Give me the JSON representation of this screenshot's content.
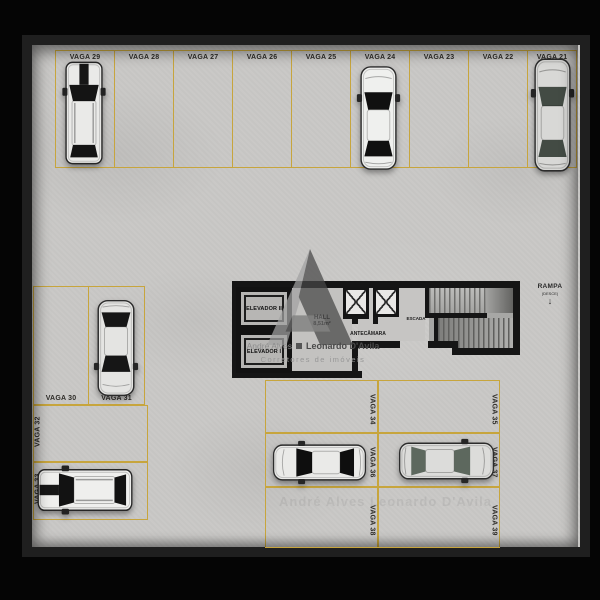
{
  "scene": {
    "description": "parking garage floor plan, top-down view"
  },
  "colors": {
    "background": "#050505",
    "wall": "#1f1f1f",
    "floor": "#c9c8c6",
    "parking_line": "#c7a53d",
    "label_text": "#2e2c28"
  },
  "spots": {
    "top_row": [
      {
        "label": "VAGA 29",
        "occupied": true
      },
      {
        "label": "VAGA 28",
        "occupied": false
      },
      {
        "label": "VAGA 27",
        "occupied": false
      },
      {
        "label": "VAGA 26",
        "occupied": false
      },
      {
        "label": "VAGA 25",
        "occupied": false
      },
      {
        "label": "VAGA 24",
        "occupied": true
      },
      {
        "label": "VAGA 23",
        "occupied": false
      },
      {
        "label": "VAGA 22",
        "occupied": false
      },
      {
        "label": "VAGA 21",
        "occupied": true
      }
    ],
    "left_block": [
      {
        "label": "VAGA 30",
        "occupied": false
      },
      {
        "label": "VAGA 31",
        "occupied": true
      },
      {
        "label": "VAGA 32",
        "occupied": false
      },
      {
        "label": "VAGA 33",
        "occupied": true
      }
    ],
    "bottom_block": [
      {
        "label": "VAGA 34",
        "occupied": false
      },
      {
        "label": "VAGA 35",
        "occupied": false
      },
      {
        "label": "VAGA 36",
        "occupied": true
      },
      {
        "label": "VAGA 37",
        "occupied": true
      },
      {
        "label": "VAGA 38",
        "occupied": false
      },
      {
        "label": "VAGA 39",
        "occupied": false
      }
    ]
  },
  "cars": [
    {
      "spot": "VAGA 29",
      "type": "suv",
      "facing": "up"
    },
    {
      "spot": "VAGA 24",
      "type": "sedan",
      "facing": "up"
    },
    {
      "spot": "VAGA 21",
      "type": "sedan",
      "facing": "up"
    },
    {
      "spot": "VAGA 31",
      "type": "sedan",
      "facing": "down"
    },
    {
      "spot": "VAGA 33",
      "type": "suv",
      "facing": "left"
    },
    {
      "spot": "VAGA 36",
      "type": "sedan",
      "facing": "left"
    },
    {
      "spot": "VAGA 37",
      "type": "sedan",
      "facing": "right"
    }
  ],
  "core": {
    "elevator_2_label": "ELEVADOR II",
    "elevator_1_label": "ELEVADOR I",
    "hall_label": "HALL",
    "hall_area": "8,51m²",
    "antechamber_label": "ANTECÂMARA",
    "stairs_label": "ESCADA"
  },
  "ramp": {
    "label": "RAMPA",
    "direction_note": "(DESCE)",
    "arrow": "↓"
  },
  "watermark": {
    "agent_left": "André Alves",
    "agent_right": "Leonardo D'Avila",
    "subtitle": "Corretores de imóveis"
  }
}
